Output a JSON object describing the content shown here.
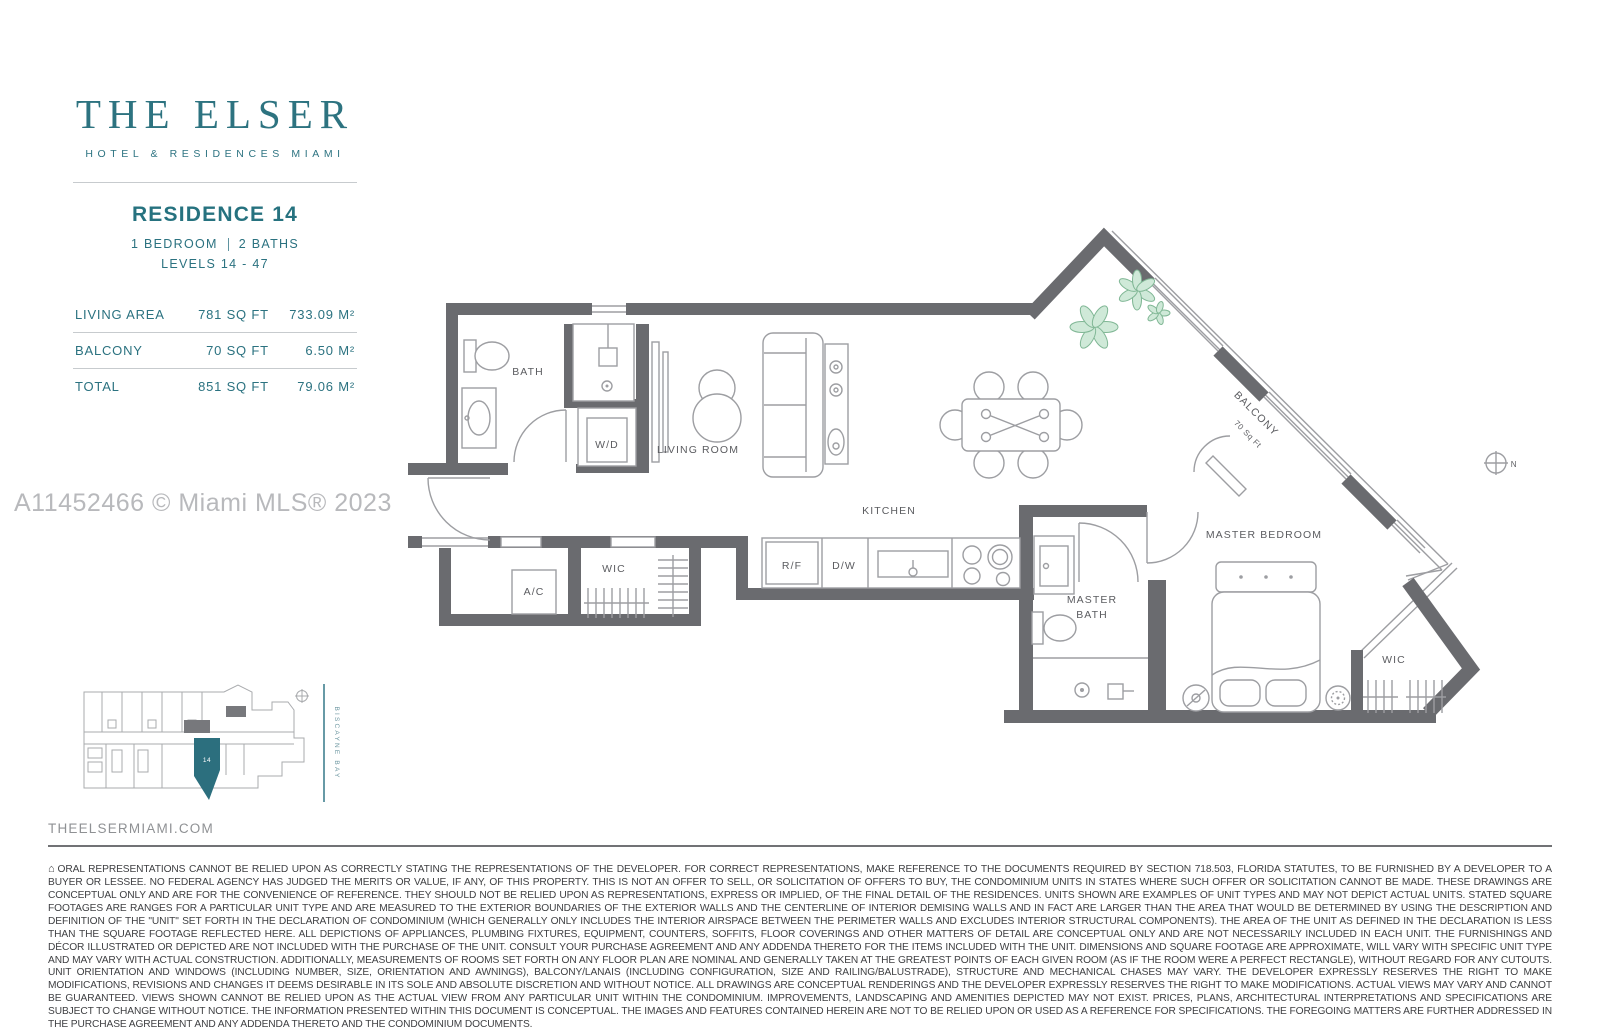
{
  "brand": {
    "title": "THE ELSER",
    "subtitle": "HOTEL & RESIDENCES MIAMI",
    "accent_color": "#2d7380"
  },
  "unit": {
    "name": "RESIDENCE 14",
    "bedrooms": "1 BEDROOM",
    "baths": "2 BATHS",
    "levels": "LEVELS 14 - 47",
    "areas": [
      {
        "label": "LIVING AREA",
        "sqft": "781 SQ FT",
        "sqm": "733.09 M²"
      },
      {
        "label": "BALCONY",
        "sqft": "70 SQ FT",
        "sqm": "6.50 M²"
      },
      {
        "label": "TOTAL",
        "sqft": "851 SQ FT",
        "sqm": "79.06 M²"
      }
    ]
  },
  "watermark": "A11452466 © Miami MLS® 2023",
  "floorplan": {
    "labels": {
      "bath": "BATH",
      "wd": "W/D",
      "living_room": "LIVING ROOM",
      "kitchen": "KITCHEN",
      "ac": "A/C",
      "wic_hall": "WIC",
      "rf": "R/F",
      "dw": "D/W",
      "master_bath_line1": "MASTER",
      "master_bath_line2": "BATH",
      "master_bedroom": "MASTER BEDROOM",
      "wic_master": "WIC",
      "balcony": "BALCONY",
      "balcony_area": "70 Sq Ft",
      "compass": "N"
    },
    "colors": {
      "wall_gray": "#6a6b6f",
      "line_gray": "#9d9ea2",
      "plant_green": "#cfe9d8"
    }
  },
  "keyplan": {
    "unit_number": "14",
    "bay_label": "BISCAYNE BAY",
    "highlight_color": "#2c6f7e"
  },
  "footer": {
    "website": "THEELSERMIAMI.COM",
    "house_icon": "⌂",
    "disclaimer": "ORAL REPRESENTATIONS CANNOT BE RELIED UPON AS CORRECTLY STATING THE REPRESENTATIONS OF THE DEVELOPER. FOR CORRECT REPRESENTATIONS, MAKE REFERENCE TO THE DOCUMENTS REQUIRED BY SECTION 718.503, FLORIDA STATUTES, TO BE FURNISHED BY A DEVELOPER TO A BUYER OR LESSEE. NO FEDERAL AGENCY HAS JUDGED THE MERITS OR VALUE, IF ANY, OF THIS PROPERTY. THIS IS NOT AN OFFER TO SELL, OR SOLICITATION OF OFFERS TO BUY, THE CONDOMINIUM UNITS IN STATES WHERE SUCH OFFER OR SOLICITATION CANNOT BE MADE. THESE DRAWINGS ARE CONCEPTUAL ONLY AND ARE FOR THE CONVENIENCE OF REFERENCE. THEY SHOULD NOT BE RELIED UPON AS REPRESENTATIONS, EXPRESS OR IMPLIED, OF THE FINAL DETAIL OF THE RESIDENCES. UNITS SHOWN ARE EXAMPLES OF UNIT TYPES AND MAY NOT DEPICT ACTUAL UNITS. STATED SQUARE FOOTAGES ARE RANGES FOR A PARTICULAR UNIT TYPE AND ARE MEASURED TO THE EXTERIOR BOUNDARIES OF THE EXTERIOR WALLS AND THE CENTERLINE OF INTERIOR DEMISING WALLS AND IN FACT ARE LARGER THAN THE AREA THAT WOULD BE DETERMINED BY USING THE DESCRIPTION AND DEFINITION OF THE \"UNIT\" SET FORTH IN THE DECLARATION OF CONDOMINIUM (WHICH GENERALLY ONLY INCLUDES THE INTERIOR AIRSPACE BETWEEN THE PERIMETER WALLS AND EXCLUDES INTERIOR STRUCTURAL COMPONENTS). THE AREA OF THE UNIT AS DEFINED IN THE DECLARATION IS LESS THAN THE SQUARE FOOTAGE REFLECTED HERE. ALL DEPICTIONS OF APPLIANCES, PLUMBING FIXTURES, EQUIPMENT, COUNTERS, SOFFITS, FLOOR COVERINGS AND OTHER MATTERS OF DETAIL ARE CONCEPTUAL ONLY AND ARE NOT NECESSARILY INCLUDED IN EACH UNIT. THE FURNISHINGS AND DÉCOR ILLUSTRATED OR DEPICTED ARE NOT INCLUDED WITH THE PURCHASE OF THE UNIT. CONSULT YOUR PURCHASE AGREEMENT AND ANY ADDENDA THERETO FOR THE ITEMS INCLUDED WITH THE UNIT. DIMENSIONS AND SQUARE FOOTAGE ARE APPROXIMATE, WILL VARY WITH SPECIFIC UNIT TYPE AND MAY VARY WITH ACTUAL CONSTRUCTION. ADDITIONALLY, MEASUREMENTS OF ROOMS SET FORTH ON ANY FLOOR PLAN ARE NOMINAL AND  GENERALLY TAKEN AT THE GREATEST POINTS OF EACH GIVEN ROOM (AS IF THE ROOM WERE A PERFECT RECTANGLE), WITHOUT REGARD FOR ANY CUTOUTS. UNIT ORIENTATION AND WINDOWS (INCLUDING NUMBER, SIZE, ORIENTATION AND AWNINGS), BALCONY/LANAIS (INCLUDING CONFIGURATION, SIZE AND RAILING/BALUSTRADE), STRUCTURE AND MECHANICAL CHASES MAY VARY. THE DEVELOPER EXPRESSLY RESERVES THE RIGHT TO MAKE MODIFICATIONS, REVISIONS AND CHANGES IT DEEMS DESIRABLE IN ITS SOLE AND ABSOLUTE DISCRETION AND WITHOUT NOTICE. ALL DRAWINGS ARE CONCEPTUAL RENDERINGS AND THE DEVELOPER EXPRESSLY RESERVES THE RIGHT TO MAKE MODIFICATIONS. ACTUAL VIEWS MAY VARY AND CANNOT BE GUARANTEED. VIEWS SHOWN CANNOT BE RELIED UPON AS THE ACTUAL VIEW FROM ANY PARTICULAR UNIT WITHIN THE CONDOMINIUM. IMPROVEMENTS, LANDSCAPING AND AMENITIES DEPICTED MAY NOT EXIST. PRICES, PLANS, ARCHITECTURAL INTERPRETATIONS AND SPECIFICATIONS ARE SUBJECT TO CHANGE WITHOUT NOTICE. THE INFORMATION PRESENTED WITHIN THIS DOCUMENT IS CONCEPTUAL. THE IMAGES AND FEATURES CONTAINED HEREIN ARE NOT TO BE RELIED UPON OR USED AS A REFERENCE FOR SPECIFICATIONS. THE FOREGOING MATTERS ARE FURTHER ADDRESSED IN THE PURCHASE AGREEMENT AND ANY ADDENDA THERETO AND THE CONDOMINIUM DOCUMENTS."
  }
}
